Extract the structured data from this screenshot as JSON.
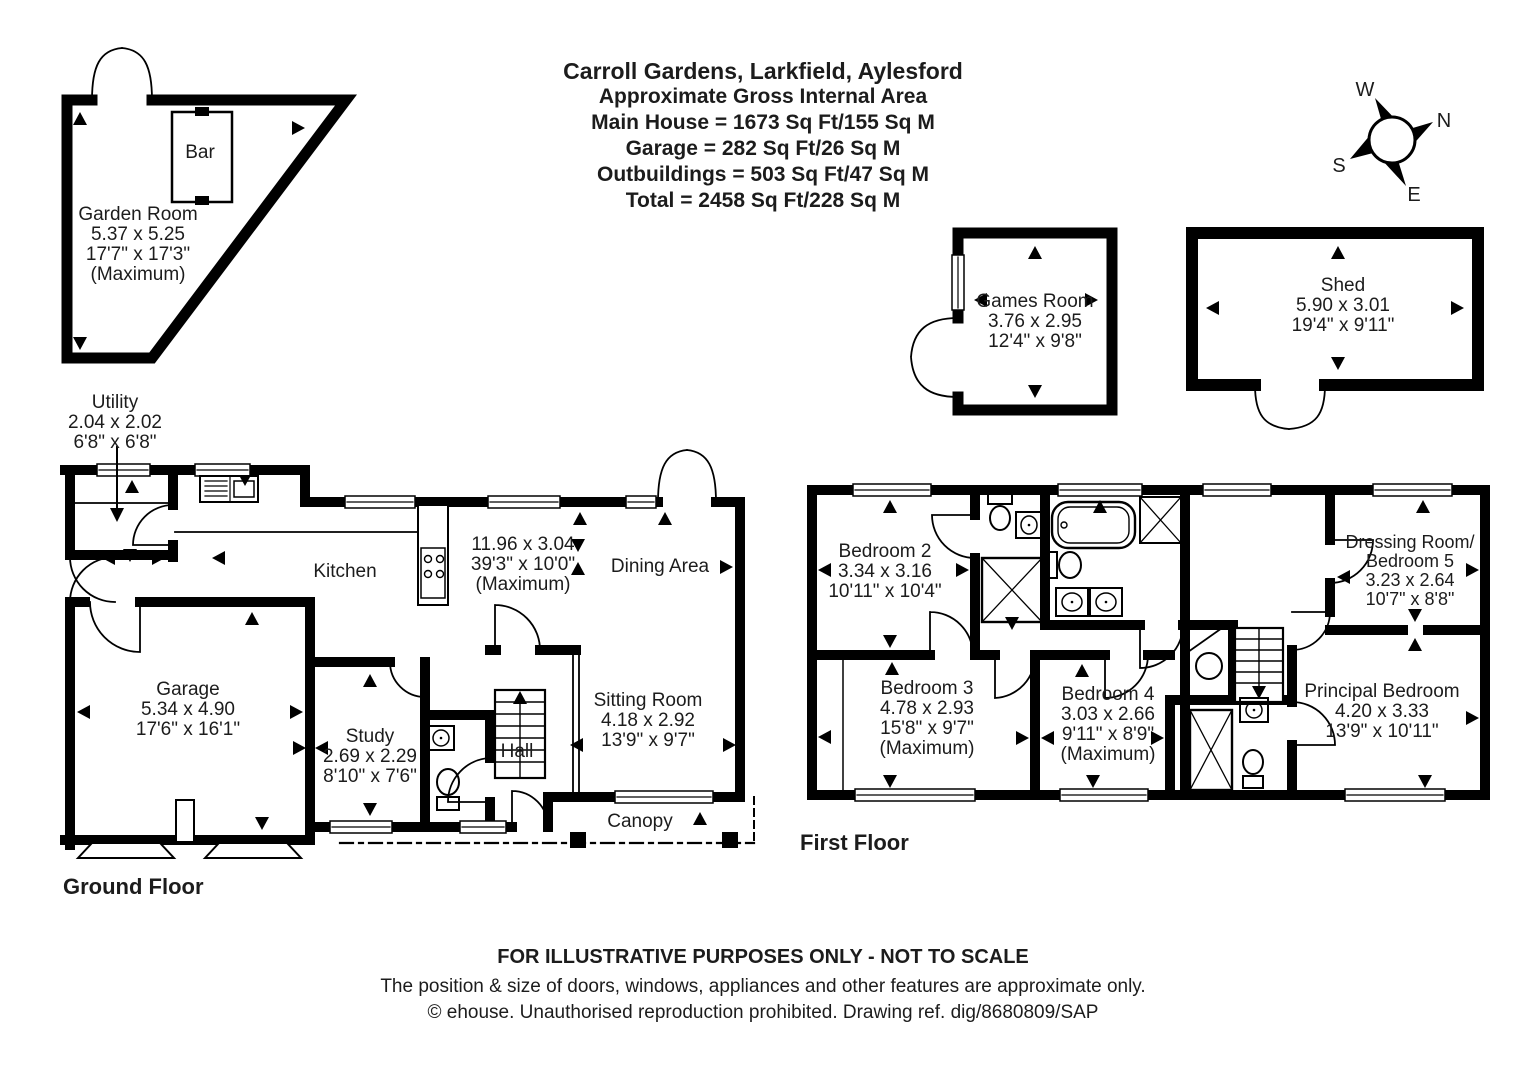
{
  "title_block": {
    "line1": "Carroll Gardens, Larkfield, Aylesford",
    "line2": "Approximate Gross Internal Area",
    "line3": "Main House = 1673 Sq Ft/155 Sq M",
    "line4": "Garage = 282 Sq Ft/26 Sq M",
    "line5": "Outbuildings = 503 Sq Ft/47 Sq M",
    "line6": "Total = 2458 Sq Ft/228 Sq M"
  },
  "compass": {
    "north": "N",
    "east": "E",
    "south": "S",
    "west": "W"
  },
  "outbuildings": {
    "garden_room": {
      "name": "Garden Room",
      "dim_m": "5.37 x 5.25",
      "dim_ft": "17'7\" x 17'3\"",
      "note": "(Maximum)"
    },
    "bar": {
      "name": "Bar"
    },
    "games_room": {
      "name": "Games Room",
      "dim_m": "3.76 x 2.95",
      "dim_ft": "12'4\" x 9'8\""
    },
    "shed": {
      "name": "Shed",
      "dim_m": "5.90 x 3.01",
      "dim_ft": "19'4\" x 9'11\""
    }
  },
  "ground_floor": {
    "label": "Ground Floor",
    "utility": {
      "name": "Utility",
      "dim_m": "2.04 x 2.02",
      "dim_ft": "6'8\" x 6'8\""
    },
    "kitchen": {
      "name": "Kitchen"
    },
    "kitchen_dining": {
      "dim_m": "11.96 x 3.04",
      "dim_ft": "39'3\" x 10'0\"",
      "note": "(Maximum)"
    },
    "dining_area": {
      "name": "Dining Area"
    },
    "garage": {
      "name": "Garage",
      "dim_m": "5.34 x 4.90",
      "dim_ft": "17'6\" x 16'1\""
    },
    "study": {
      "name": "Study",
      "dim_m": "2.69 x 2.29",
      "dim_ft": "8'10\" x 7'6\""
    },
    "hall": {
      "name": "Hall"
    },
    "sitting_room": {
      "name": "Sitting Room",
      "dim_m": "4.18 x 2.92",
      "dim_ft": "13'9\" x 9'7\""
    },
    "canopy": {
      "name": "Canopy"
    }
  },
  "first_floor": {
    "label": "First Floor",
    "bedroom2": {
      "name": "Bedroom 2",
      "dim_m": "3.34 x 3.16",
      "dim_ft": "10'11\" x 10'4\""
    },
    "bedroom3": {
      "name": "Bedroom 3",
      "dim_m": "4.78 x 2.93",
      "dim_ft": "15'8\" x 9'7\"",
      "note": "(Maximum)"
    },
    "bedroom4": {
      "name": "Bedroom 4",
      "dim_m": "3.03 x 2.66",
      "dim_ft": "9'11\" x 8'9\"",
      "note": "(Maximum)"
    },
    "principal_bedroom": {
      "name": "Principal Bedroom",
      "dim_m": "4.20 x 3.33",
      "dim_ft": "13'9\" x 10'11\""
    },
    "dressing_room": {
      "name_line1": "Dressing Room/",
      "name_line2": "Bedroom 5",
      "dim_m": "3.23 x 2.64",
      "dim_ft": "10'7\" x 8'8\""
    }
  },
  "footer": {
    "line1": "FOR ILLUSTRATIVE PURPOSES ONLY - NOT TO SCALE",
    "line2": "The position & size of doors, windows, appliances and other features are approximate only.",
    "line3": "© ehouse. Unauthorised reproduction prohibited. Drawing ref. dig/8680809/SAP"
  }
}
